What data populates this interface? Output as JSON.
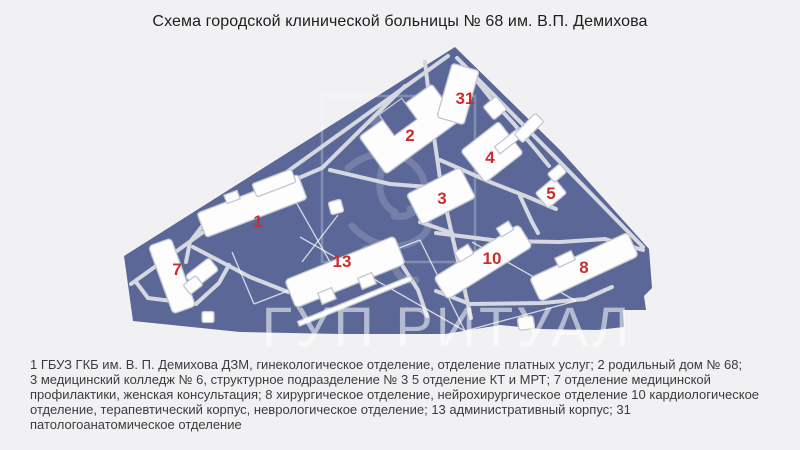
{
  "title": "Схема городской клинической больницы № 68 им. В.П. Демихова",
  "map": {
    "watermark": "ГУП РИТУАЛ",
    "colors": {
      "territory": "#5a6797",
      "roads": "#d5d8e0",
      "building_fill": "#fdfdfe",
      "building_stroke": "#c2c7d2",
      "label_red": "#cb2d2d",
      "page_background": "#f1f1f3"
    },
    "buildings": [
      {
        "label": "1"
      },
      {
        "label": "2"
      },
      {
        "label": "3"
      },
      {
        "label": "4"
      },
      {
        "label": "5"
      },
      {
        "label": "7"
      },
      {
        "label": "8"
      },
      {
        "label": "10"
      },
      {
        "label": "13"
      },
      {
        "label": "31"
      }
    ]
  },
  "caption": {
    "lines": [
      "1 ГБУЗ ГКБ им. В. П. Демихова ДЗМ, гинекологическое отделение, отделение платных услуг; 2 родильный дом № 68;",
      "3 медицинский колледж № 6, структурное подразделение № 3 5 отделение КТ и МРТ; 7 отделение медицинской",
      "профилактики, женская консультация; 8 хирургическое отделение, нейрохирургическое отделение 10 кардиологическое",
      "отделение, терапевтический корпус, неврологическое отделение; 13 административный корпус; 31",
      "патологоанатомическое отделение"
    ]
  }
}
